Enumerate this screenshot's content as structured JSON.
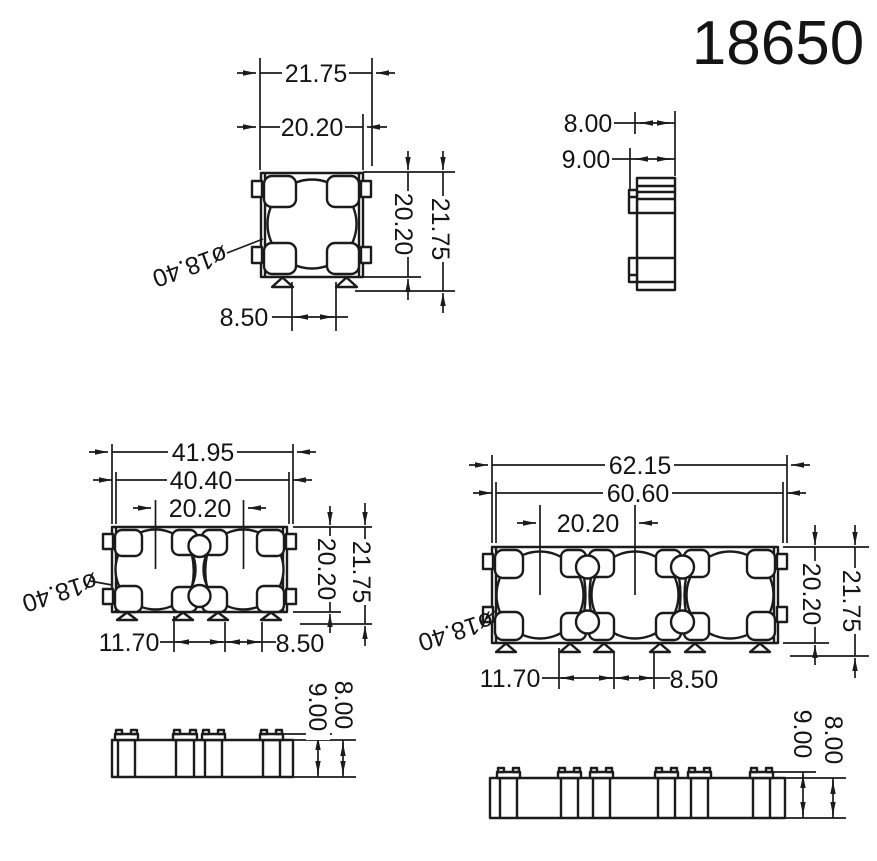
{
  "title": "18650",
  "colors": {
    "ink": "#1b1b1b",
    "background": "#ffffff"
  },
  "views": {
    "single_front": {
      "dims": {
        "width_outer": "21.75",
        "width_inner": "20.20",
        "height_inner": "20.20",
        "height_outer": "21.75",
        "pin_spacing": "8.50",
        "cell_diameter": "ø18.40"
      }
    },
    "single_side": {
      "dims": {
        "depth_body": "8.00",
        "depth_total": "9.00"
      }
    },
    "double_front": {
      "dims": {
        "width_outer": "41.95",
        "width_inner": "40.40",
        "cell_pitch": "20.20",
        "height_inner": "20.20",
        "height_outer": "21.75",
        "pin_offset": "11.70",
        "pin_spacing": "8.50",
        "cell_diameter": "ø18.40"
      }
    },
    "double_side": {
      "dims": {
        "depth_total": "9.00",
        "depth_body": "8.00"
      }
    },
    "triple_front": {
      "dims": {
        "width_outer": "62.15",
        "width_inner": "60.60",
        "cell_pitch": "20.20",
        "height_outer": "21.75",
        "height_inner": "20.20",
        "pin_offset": "11.70",
        "pin_spacing": "8.50",
        "cell_diameter": "ø18.40"
      }
    },
    "triple_side": {
      "dims": {
        "depth_total": "9.00",
        "depth_body": "8.00"
      }
    }
  }
}
